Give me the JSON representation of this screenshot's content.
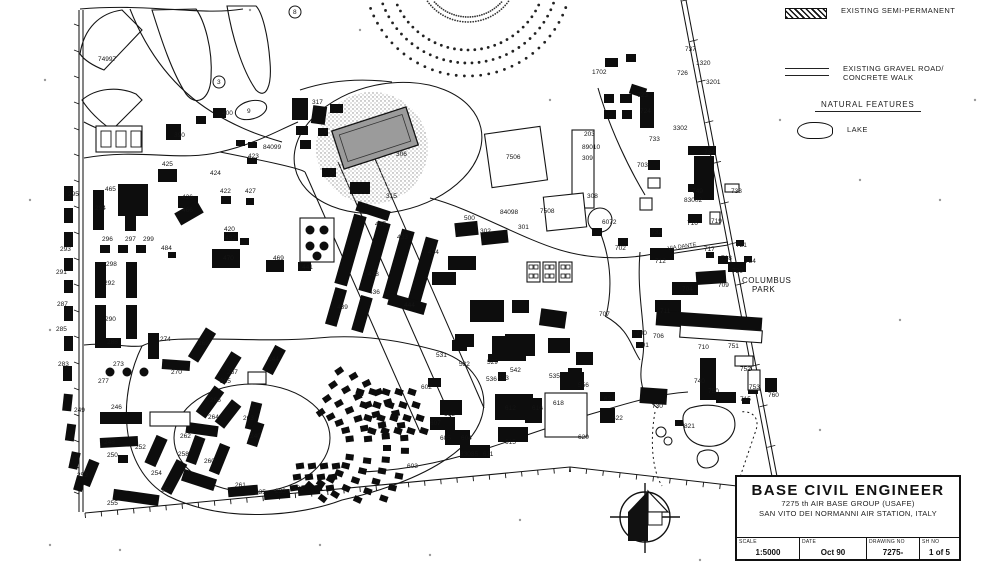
{
  "page": {
    "background": "#ffffff",
    "ink": "#161616"
  },
  "legend": {
    "semi_permanent": "EXISTING SEMI-PERMANENT",
    "gravel_road_line1": "EXISTING GRAVEL ROAD/",
    "gravel_road_line2": "CONCRETE WALK",
    "natural_features": "NATURAL FEATURES",
    "lake": "LAKE"
  },
  "title_block": {
    "title": "BASE CIVIL ENGINEER",
    "org_line1": "7275 th  AIR BASE GROUP (USAFE)",
    "org_line2": "SAN VITO DEI NORMANNI AIR STATION, ITALY",
    "scale_label": "SCALE",
    "scale_value": "1:5000",
    "date_label": "DATE",
    "date_value": "Oct 90",
    "drawing_no_label": "DRAWING NO",
    "drawing_no_value": "7275-",
    "sheet_label": "SH NO",
    "sheet_value": "1 of 5"
  },
  "map": {
    "area_names": [
      {
        "text": "COLUMBUS",
        "x": 742,
        "y": 283
      },
      {
        "text": "PARK",
        "x": 752,
        "y": 292
      }
    ],
    "street_names": [
      {
        "text": "VIA DANTE",
        "x": 668,
        "y": 250,
        "rot": -8
      }
    ],
    "labels": [
      {
        "t": "74997",
        "x": 98,
        "y": 61
      },
      {
        "t": "8",
        "x": 293,
        "y": 14,
        "c": 1
      },
      {
        "t": "3",
        "x": 217,
        "y": 84,
        "c": 1
      },
      {
        "t": "9",
        "x": 247,
        "y": 113
      },
      {
        "t": "400",
        "x": 222,
        "y": 115
      },
      {
        "t": "390",
        "x": 174,
        "y": 137
      },
      {
        "t": "84099",
        "x": 263,
        "y": 149
      },
      {
        "t": "423",
        "x": 248,
        "y": 158
      },
      {
        "t": "425",
        "x": 162,
        "y": 166
      },
      {
        "t": "424",
        "x": 210,
        "y": 175
      },
      {
        "t": "422",
        "x": 220,
        "y": 193
      },
      {
        "t": "427",
        "x": 245,
        "y": 193
      },
      {
        "t": "426",
        "x": 182,
        "y": 199
      },
      {
        "t": "465",
        "x": 105,
        "y": 191
      },
      {
        "t": "466",
        "x": 182,
        "y": 212
      },
      {
        "t": "420",
        "x": 224,
        "y": 231
      },
      {
        "t": "432",
        "x": 225,
        "y": 240
      },
      {
        "t": "470",
        "x": 223,
        "y": 260
      },
      {
        "t": "469",
        "x": 273,
        "y": 260
      },
      {
        "t": "441",
        "x": 302,
        "y": 269
      },
      {
        "t": "484",
        "x": 161,
        "y": 250
      },
      {
        "t": "317",
        "x": 312,
        "y": 104
      },
      {
        "t": "306",
        "x": 396,
        "y": 156
      },
      {
        "t": "315",
        "x": 386,
        "y": 198
      },
      {
        "t": "1702",
        "x": 592,
        "y": 74
      },
      {
        "t": "737",
        "x": 685,
        "y": 51
      },
      {
        "t": "726",
        "x": 677,
        "y": 75
      },
      {
        "t": "1320",
        "x": 696,
        "y": 65
      },
      {
        "t": "3201",
        "x": 706,
        "y": 84
      },
      {
        "t": "723",
        "x": 637,
        "y": 97
      },
      {
        "t": "724",
        "x": 640,
        "y": 113
      },
      {
        "t": "733",
        "x": 649,
        "y": 141
      },
      {
        "t": "3302",
        "x": 673,
        "y": 130
      },
      {
        "t": "203",
        "x": 584,
        "y": 136
      },
      {
        "t": "89010",
        "x": 582,
        "y": 149
      },
      {
        "t": "309",
        "x": 582,
        "y": 160
      },
      {
        "t": "703",
        "x": 637,
        "y": 167
      },
      {
        "t": "734",
        "x": 704,
        "y": 154
      },
      {
        "t": "749",
        "x": 692,
        "y": 193
      },
      {
        "t": "83002",
        "x": 684,
        "y": 202
      },
      {
        "t": "738",
        "x": 731,
        "y": 193
      },
      {
        "t": "308",
        "x": 587,
        "y": 198
      },
      {
        "t": "7506",
        "x": 506,
        "y": 159
      },
      {
        "t": "500",
        "x": 464,
        "y": 220
      },
      {
        "t": "84098",
        "x": 500,
        "y": 214
      },
      {
        "t": "7508",
        "x": 540,
        "y": 213
      },
      {
        "t": "301",
        "x": 518,
        "y": 229
      },
      {
        "t": "302",
        "x": 480,
        "y": 233
      },
      {
        "t": "6072",
        "x": 602,
        "y": 224
      },
      {
        "t": "702",
        "x": 615,
        "y": 250
      },
      {
        "t": "732",
        "x": 651,
        "y": 234
      },
      {
        "t": "712",
        "x": 655,
        "y": 263
      },
      {
        "t": "717",
        "x": 704,
        "y": 251
      },
      {
        "t": "718",
        "x": 721,
        "y": 260
      },
      {
        "t": "721",
        "x": 736,
        "y": 247
      },
      {
        "t": "754",
        "x": 745,
        "y": 263
      },
      {
        "t": "720",
        "x": 732,
        "y": 273
      },
      {
        "t": "704",
        "x": 682,
        "y": 291
      },
      {
        "t": "709",
        "x": 718,
        "y": 287
      },
      {
        "t": "716",
        "x": 687,
        "y": 225
      },
      {
        "t": "719",
        "x": 711,
        "y": 223
      },
      {
        "t": "711",
        "x": 660,
        "y": 313
      },
      {
        "t": "707",
        "x": 599,
        "y": 316
      },
      {
        "t": "700",
        "x": 636,
        "y": 335
      },
      {
        "t": "701",
        "x": 638,
        "y": 347
      },
      {
        "t": "706",
        "x": 653,
        "y": 338
      },
      {
        "t": "710",
        "x": 698,
        "y": 349
      },
      {
        "t": "751",
        "x": 728,
        "y": 348
      },
      {
        "t": "752",
        "x": 740,
        "y": 371
      },
      {
        "t": "740",
        "x": 694,
        "y": 383
      },
      {
        "t": "750",
        "x": 708,
        "y": 393
      },
      {
        "t": "753",
        "x": 749,
        "y": 389
      },
      {
        "t": "760",
        "x": 768,
        "y": 397
      },
      {
        "t": "730",
        "x": 652,
        "y": 408
      },
      {
        "t": "715",
        "x": 740,
        "y": 401
      },
      {
        "t": "821",
        "x": 684,
        "y": 428
      },
      {
        "t": "621",
        "x": 604,
        "y": 401
      },
      {
        "t": "622",
        "x": 612,
        "y": 420
      },
      {
        "t": "620",
        "x": 578,
        "y": 439
      },
      {
        "t": "616",
        "x": 532,
        "y": 410
      },
      {
        "t": "618",
        "x": 553,
        "y": 405
      },
      {
        "t": "615",
        "x": 505,
        "y": 444
      },
      {
        "t": "612",
        "x": 505,
        "y": 410
      },
      {
        "t": "608",
        "x": 444,
        "y": 416
      },
      {
        "t": "607",
        "x": 430,
        "y": 425
      },
      {
        "t": "605",
        "x": 440,
        "y": 440
      },
      {
        "t": "604",
        "x": 461,
        "y": 440
      },
      {
        "t": "83085",
        "x": 460,
        "y": 456
      },
      {
        "t": "611",
        "x": 483,
        "y": 456
      },
      {
        "t": "603",
        "x": 407,
        "y": 468
      },
      {
        "t": "602",
        "x": 421,
        "y": 389
      },
      {
        "t": "531",
        "x": 436,
        "y": 357
      },
      {
        "t": "532",
        "x": 459,
        "y": 366
      },
      {
        "t": "529",
        "x": 487,
        "y": 364
      },
      {
        "t": "542",
        "x": 510,
        "y": 372
      },
      {
        "t": "533",
        "x": 498,
        "y": 380
      },
      {
        "t": "536",
        "x": 486,
        "y": 381
      },
      {
        "t": "535",
        "x": 549,
        "y": 378
      },
      {
        "t": "556",
        "x": 578,
        "y": 387
      },
      {
        "t": "437",
        "x": 375,
        "y": 226
      },
      {
        "t": "433",
        "x": 397,
        "y": 239
      },
      {
        "t": "434",
        "x": 428,
        "y": 254
      },
      {
        "t": "438",
        "x": 368,
        "y": 276
      },
      {
        "t": "436",
        "x": 369,
        "y": 294
      },
      {
        "t": "439",
        "x": 337,
        "y": 309
      },
      {
        "t": "444",
        "x": 404,
        "y": 307
      },
      {
        "t": "295",
        "x": 68,
        "y": 196
      },
      {
        "t": "294",
        "x": 95,
        "y": 210
      },
      {
        "t": "296",
        "x": 102,
        "y": 241
      },
      {
        "t": "297",
        "x": 125,
        "y": 241
      },
      {
        "t": "299",
        "x": 143,
        "y": 241
      },
      {
        "t": "293",
        "x": 60,
        "y": 251
      },
      {
        "t": "298",
        "x": 106,
        "y": 266
      },
      {
        "t": "291",
        "x": 56,
        "y": 274
      },
      {
        "t": "292",
        "x": 104,
        "y": 285
      },
      {
        "t": "287",
        "x": 57,
        "y": 306
      },
      {
        "t": "290",
        "x": 105,
        "y": 321
      },
      {
        "t": "285",
        "x": 56,
        "y": 331
      },
      {
        "t": "288",
        "x": 107,
        "y": 344
      },
      {
        "t": "283",
        "x": 58,
        "y": 366
      },
      {
        "t": "273",
        "x": 113,
        "y": 366
      },
      {
        "t": "277",
        "x": 98,
        "y": 383
      },
      {
        "t": "270",
        "x": 171,
        "y": 374
      },
      {
        "t": "274",
        "x": 160,
        "y": 341
      },
      {
        "t": "269",
        "x": 198,
        "y": 345
      },
      {
        "t": "267",
        "x": 227,
        "y": 374
      },
      {
        "t": "265",
        "x": 220,
        "y": 383
      },
      {
        "t": "266",
        "x": 210,
        "y": 402
      },
      {
        "t": "264",
        "x": 208,
        "y": 419
      },
      {
        "t": "263",
        "x": 243,
        "y": 420
      },
      {
        "t": "262",
        "x": 180,
        "y": 438
      },
      {
        "t": "261",
        "x": 235,
        "y": 487
      },
      {
        "t": "260",
        "x": 204,
        "y": 463
      },
      {
        "t": "258",
        "x": 178,
        "y": 456
      },
      {
        "t": "256",
        "x": 161,
        "y": 492
      },
      {
        "t": "254",
        "x": 151,
        "y": 475
      },
      {
        "t": "255",
        "x": 107,
        "y": 505
      },
      {
        "t": "253",
        "x": 77,
        "y": 477
      },
      {
        "t": "252",
        "x": 135,
        "y": 449
      },
      {
        "t": "250",
        "x": 107,
        "y": 457
      },
      {
        "t": "249",
        "x": 74,
        "y": 412
      },
      {
        "t": "248",
        "x": 104,
        "y": 444
      },
      {
        "t": "246",
        "x": 111,
        "y": 409
      },
      {
        "t": "244",
        "x": 268,
        "y": 361
      },
      {
        "t": "240",
        "x": 250,
        "y": 438
      },
      {
        "t": "231",
        "x": 293,
        "y": 490
      },
      {
        "t": "233",
        "x": 275,
        "y": 493
      },
      {
        "t": "235",
        "x": 255,
        "y": 494
      }
    ]
  }
}
